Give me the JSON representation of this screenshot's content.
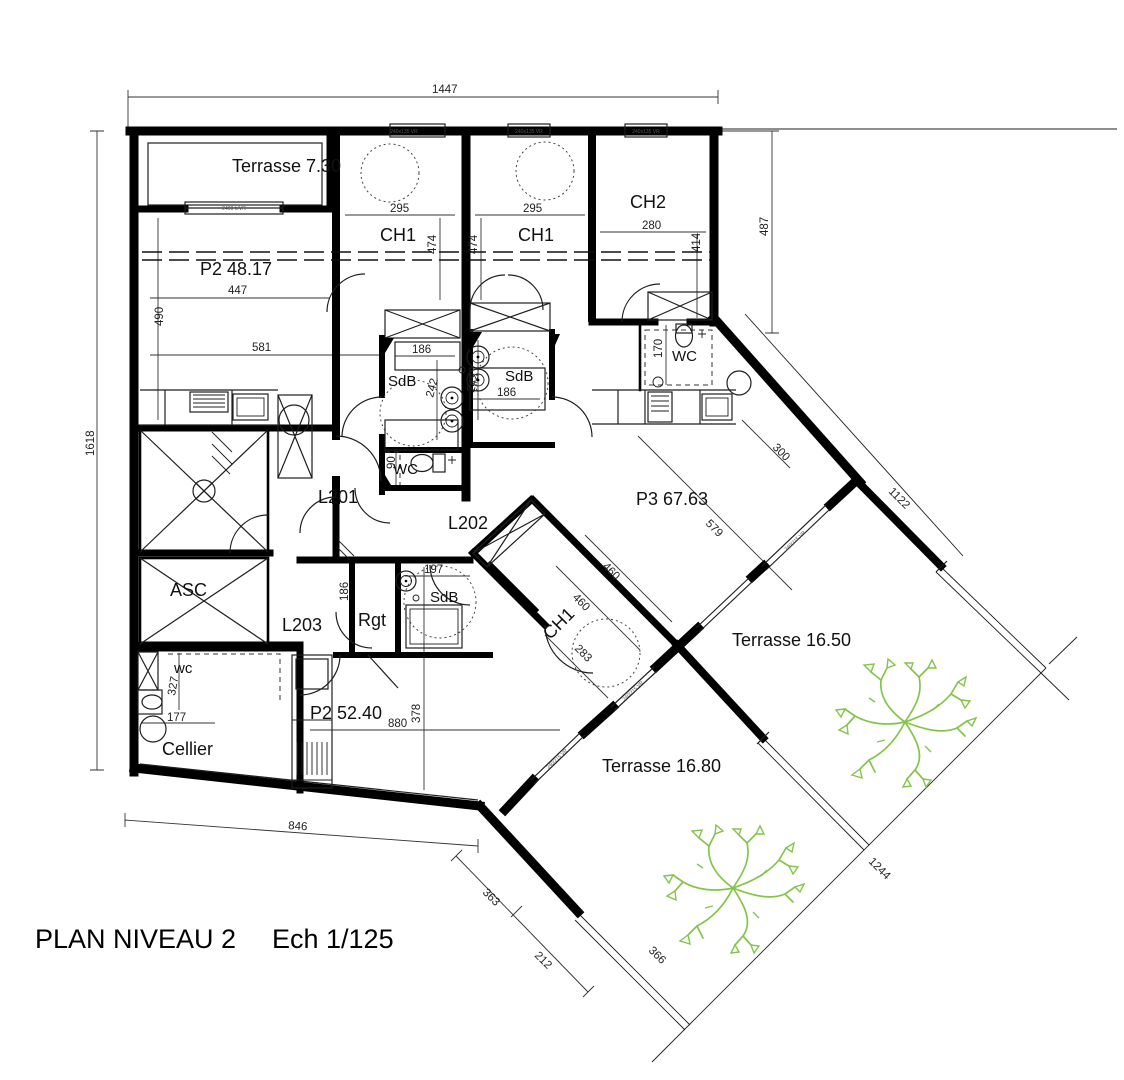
{
  "colors": {
    "wall": "#000000",
    "line": "#1f1f1f",
    "dim": "#333333",
    "tree": "#84c44b",
    "tag_text": "#555555"
  },
  "title": {
    "main": "PLAN NIVEAU 2",
    "scale": "Ech 1/125"
  },
  "rooms": {
    "terrasse_730": "Terrasse 7.30",
    "p2_4817": "P2 48.17",
    "ch1_a": "CH1",
    "ch1_b": "CH1",
    "ch2": "CH2",
    "sdb_a": "SdB",
    "sdb_b": "SdB",
    "sdb_c": "SdB",
    "wc_mid": "WC",
    "wc_tr": "WC",
    "wc_bl": "wc",
    "l201": "L201",
    "l202": "L202",
    "l203": "L203",
    "asc": "ASC",
    "p3_6763": "P3 67.63",
    "rgt": "Rgt",
    "ch1_c": "CH1",
    "p2_5240": "P2 52.40",
    "cellier": "Cellier",
    "terrasse_1650": "Terrasse 16.50",
    "terrasse_1680": "Terrasse 16.80"
  },
  "dimensions": {
    "top": "1447",
    "left": "1618",
    "right": "487",
    "bottom": "846",
    "p2_width": "447",
    "p2_height": "490",
    "p2_inner": "581",
    "ch1a_w": "295",
    "ch1a_h": "474",
    "ch1b_w": "295",
    "ch1b_h": "474",
    "ch2_w": "280",
    "ch2_h": "414",
    "sdba_w": "186",
    "sdba_h": "242",
    "sdbb_w": "186",
    "sdbb_h": "242",
    "wc_mid_w": "90",
    "wc_tr_w": "170",
    "p3_diag": "579",
    "p3_win": "300",
    "site_ne": "1122",
    "sdbc_w": "197",
    "rgt_h": "186",
    "ch1c_a": "460",
    "ch1c_b": "460",
    "ch1c_c": "283",
    "p2b_w": "880",
    "p2b_h": "378",
    "wc_bl_h": "327",
    "wc_bl_w": "177",
    "diag_a": "363",
    "diag_b": "212",
    "site_se": "1244",
    "terrace_d": "366"
  },
  "micro_labels": {
    "window_tag_1": "240x135 VR",
    "window_tag_2": "240x135 VR",
    "window_tag_3": "240x135 VR",
    "terrace_window": "2400 h/VR",
    "facade_a": "240/215 VR",
    "facade_b": "240/215 VR",
    "facade_c": "240/215 VR"
  }
}
